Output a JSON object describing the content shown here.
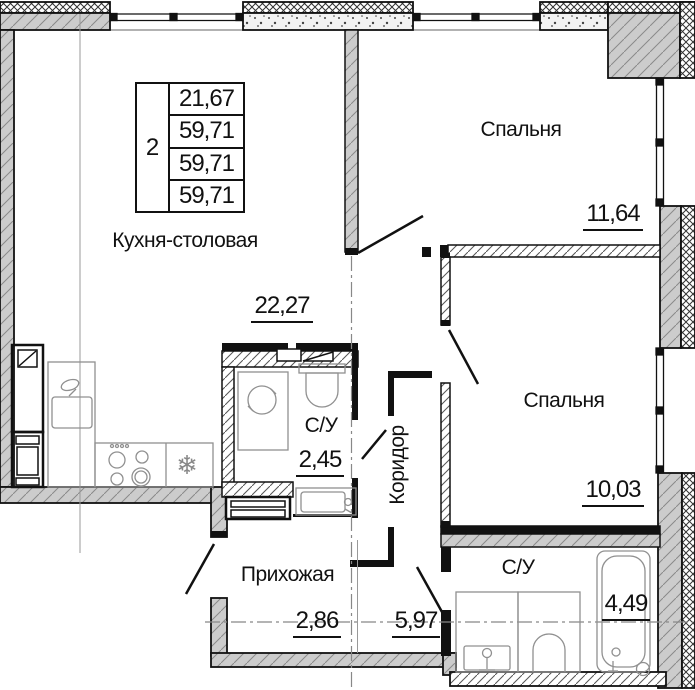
{
  "plan": {
    "type": "floor-plan",
    "rooms": [
      {
        "id": "kitchen",
        "label": "Кухня-столовая",
        "area": "22,27"
      },
      {
        "id": "bedroom1",
        "label": "Спальня",
        "area": "11,64"
      },
      {
        "id": "bedroom2",
        "label": "Спальня",
        "area": "10,03"
      },
      {
        "id": "bathroom1",
        "label": "С/У",
        "area": "2,45"
      },
      {
        "id": "corridor",
        "label": "Коридор",
        "area": "5,97"
      },
      {
        "id": "hallway",
        "label": "Прихожая",
        "area": "2,86"
      },
      {
        "id": "bathroom2",
        "label": "С/У",
        "area": "4,49"
      }
    ],
    "summary_table": {
      "rooms_count": "2",
      "rows": [
        "21,67",
        "59,71",
        "59,71",
        "59,71"
      ]
    },
    "icons": {
      "fridge": "❄"
    },
    "colors": {
      "line": "#111111",
      "wall_fill": "#cccccc",
      "fixture_line": "#909090",
      "axis_line": "#888888"
    }
  }
}
